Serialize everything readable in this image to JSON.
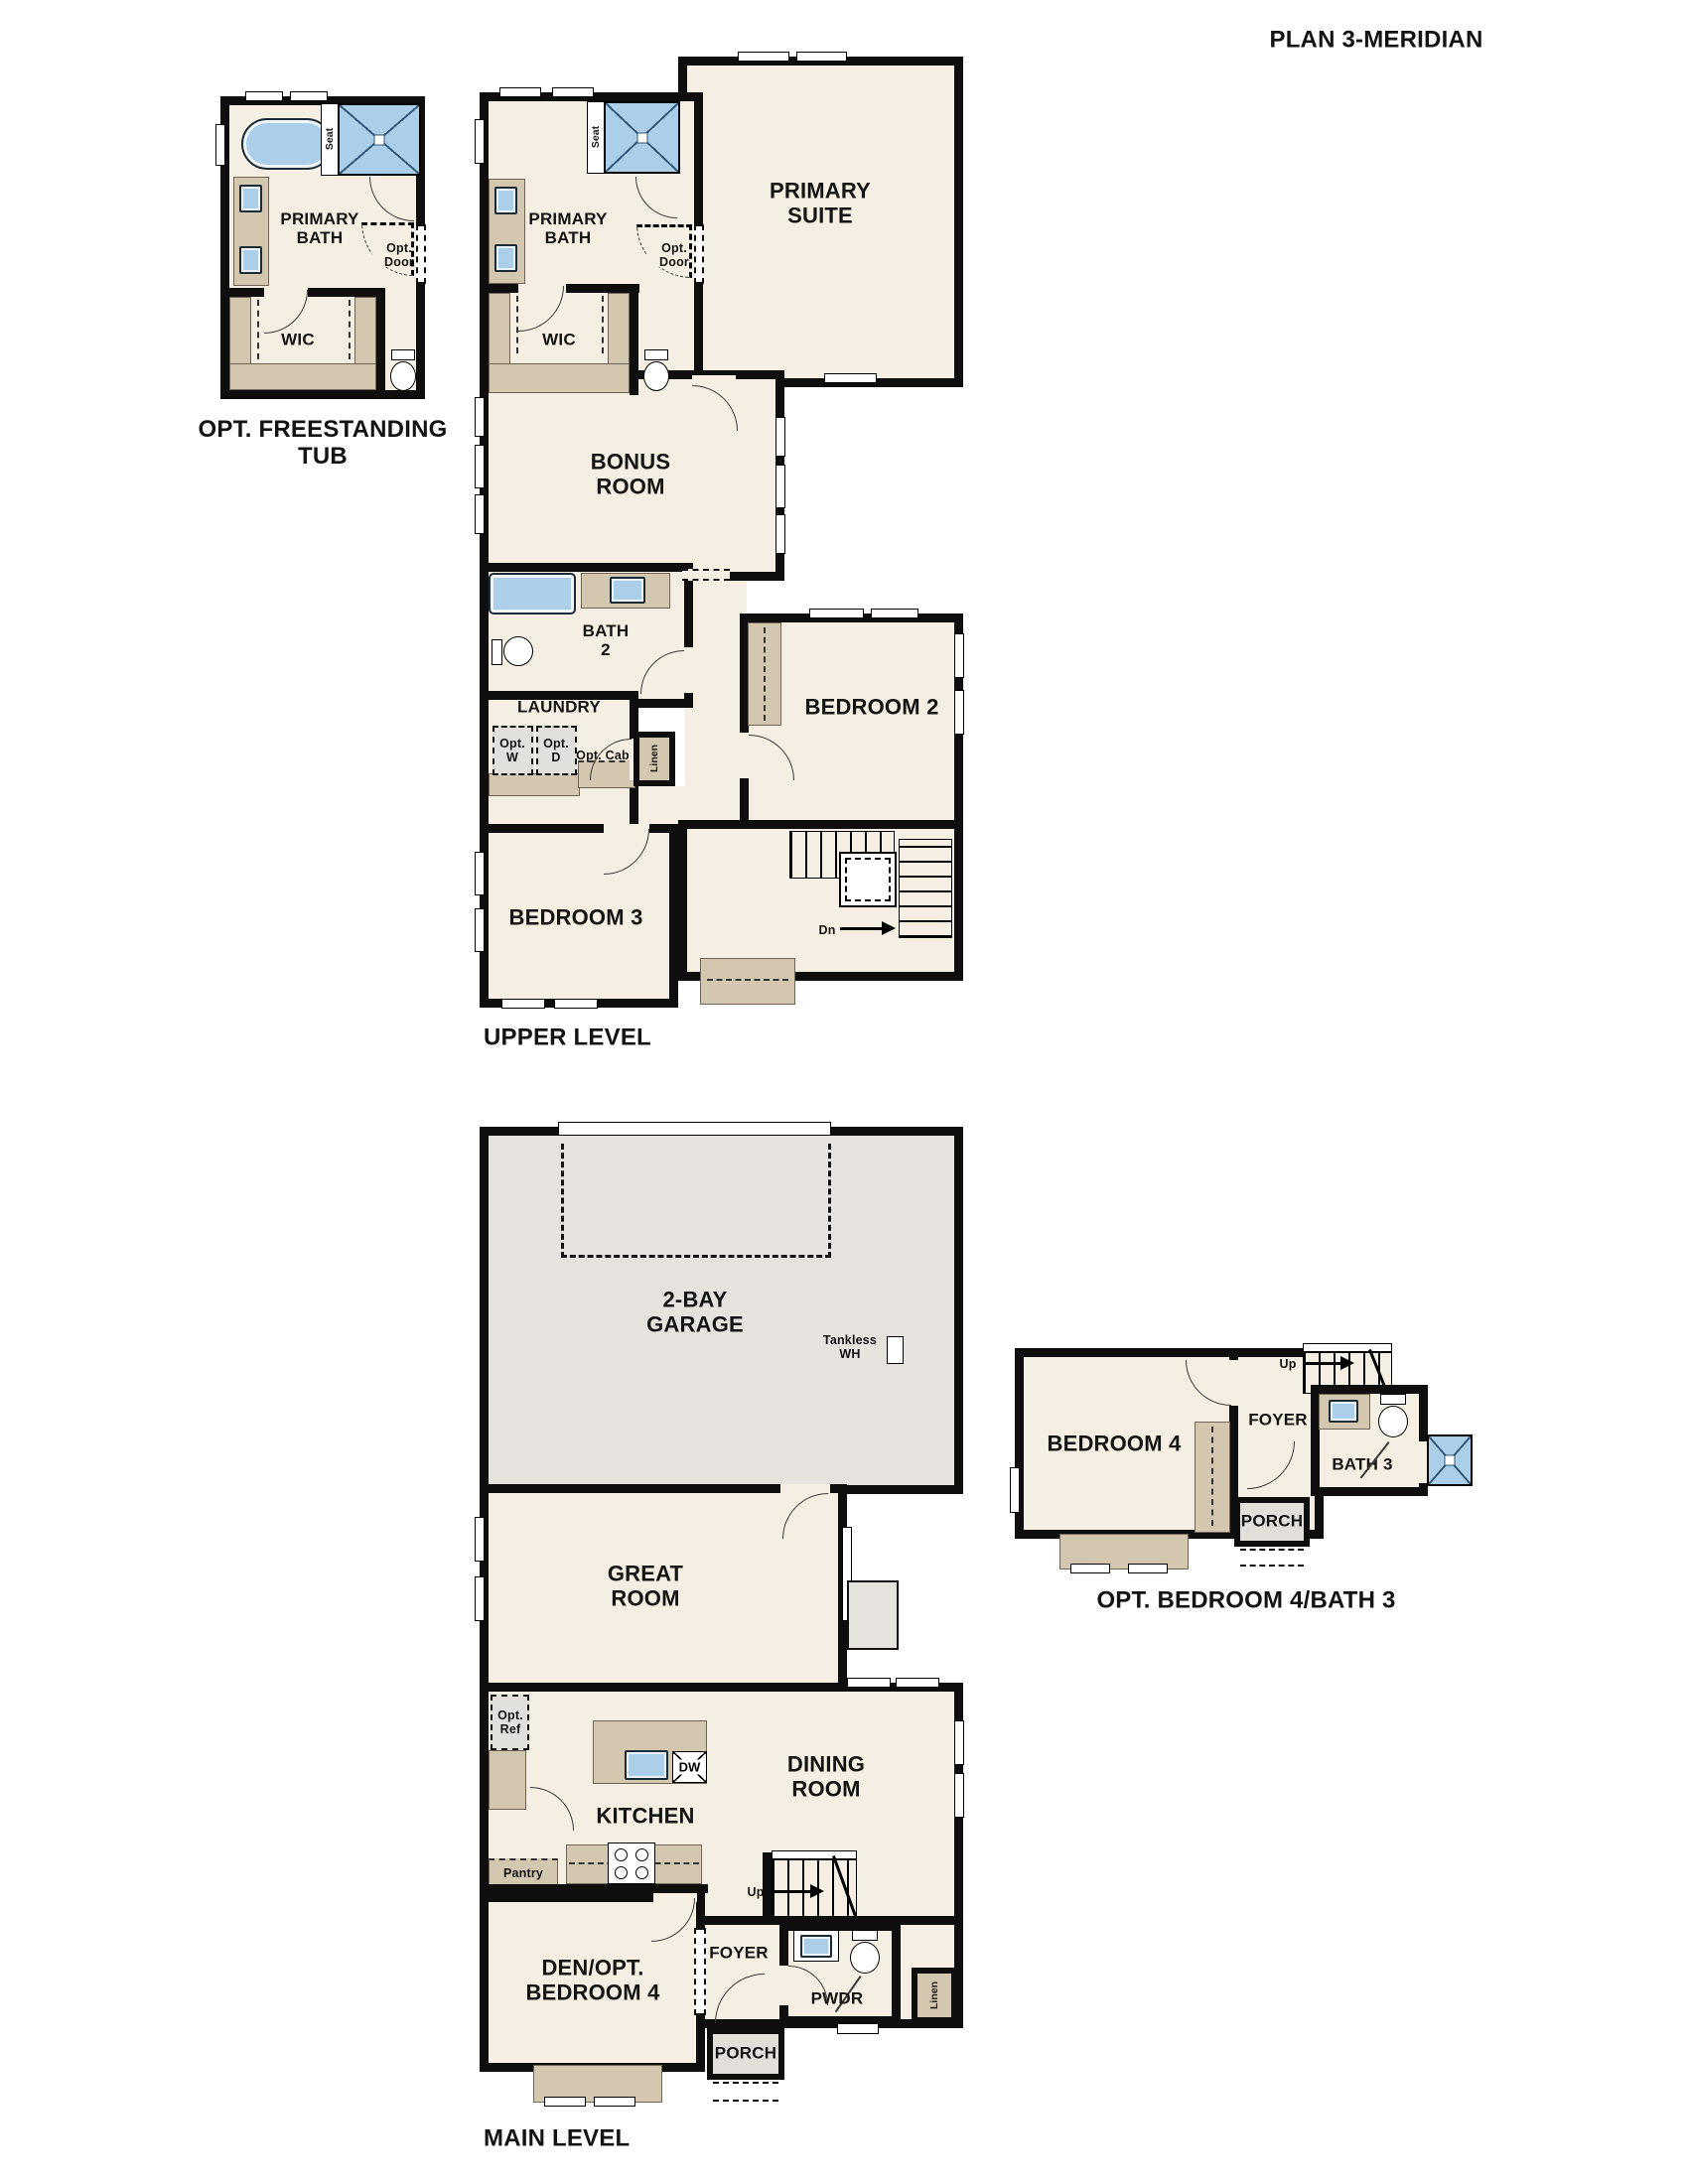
{
  "title": "PLAN 3-MERIDIAN",
  "captions": {
    "opt_tub": "OPT. FREESTANDING\nTUB",
    "upper": "UPPER LEVEL",
    "main": "MAIN LEVEL",
    "opt_bed4": "OPT. BEDROOM 4/BATH 3"
  },
  "rooms": {
    "primary_bath": "PRIMARY\nBATH",
    "primary_suite": "PRIMARY\nSUITE",
    "wic": "WIC",
    "bonus_room": "BONUS\nROOM",
    "bath2": "BATH\n2",
    "laundry": "LAUNDRY",
    "bedroom2": "BEDROOM 2",
    "bedroom3": "BEDROOM 3",
    "garage": "2-BAY\nGARAGE",
    "great_room": "GREAT\nROOM",
    "kitchen": "KITCHEN",
    "dining_room": "DINING\nROOM",
    "den": "DEN/OPT.\nBEDROOM 4",
    "foyer": "FOYER",
    "pwdr": "PWDR",
    "porch": "PORCH",
    "bedroom4": "BEDROOM 4",
    "bath3": "BATH 3"
  },
  "annotations": {
    "seat": "Seat",
    "opt_door": "Opt.\nDoor",
    "opt_w": "Opt.\nW",
    "opt_d": "Opt.\nD",
    "opt_cab": "Opt. Cab",
    "linen": "Linen",
    "dn": "Dn",
    "up": "Up",
    "tankless_wh": "Tankless\nWH",
    "opt_ref": "Opt.\nRef",
    "dw": "DW",
    "pantry": "Pantry"
  },
  "colors": {
    "wall": "#0e0e0e",
    "floor": "#f4efe2",
    "cabinet": "#d3c7af",
    "blue": "#abcfe9",
    "garage": "#e6e3df",
    "porch": "#e2dfda",
    "appl": "#e0e1dd"
  }
}
